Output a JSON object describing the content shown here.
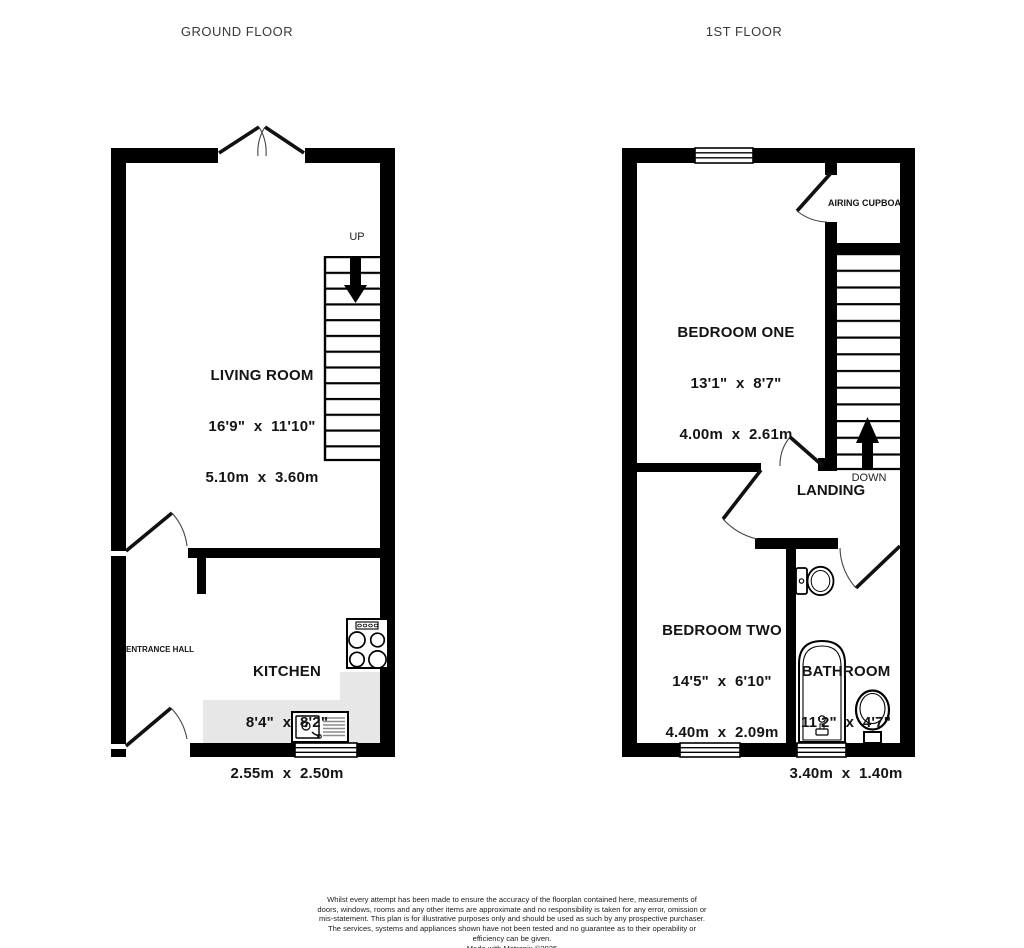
{
  "titles": {
    "ground": "GROUND FLOOR",
    "first": "1ST FLOOR"
  },
  "rooms": {
    "living_room": {
      "name": "LIVING ROOM",
      "imperial": "16'9\"  x  11'10\"",
      "metric": "5.10m  x  3.60m"
    },
    "kitchen": {
      "name": "KITCHEN",
      "imperial": "8'4\"  x  8'2\"",
      "metric": "2.55m  x  2.50m"
    },
    "bedroom_one": {
      "name": "BEDROOM ONE",
      "imperial": "13'1\"  x  8'7\"",
      "metric": "4.00m  x  2.61m"
    },
    "bedroom_two": {
      "name": "BEDROOM TWO",
      "imperial": "14'5\"  x  6'10\"",
      "metric": "4.40m  x  2.09m"
    },
    "bathroom": {
      "name": "BATHROOM",
      "imperial": "11'2\"  x  4'7\"",
      "metric": "3.40m  x  1.40m"
    }
  },
  "labels": {
    "entrance_hall": "ENTRANCE HALL",
    "airing_cupboard": "AIRING CUPBOARD",
    "landing": "LANDING",
    "up": "UP",
    "down": "DOWN"
  },
  "footer": {
    "disclaimer": "Whilst every attempt has been made to ensure the accuracy of the floorplan contained here, measurements of doors, windows, rooms and any other items are approximate and no responsibility is taken for any error, omission or mis-statement. This plan is for illustrative purposes only and should be used as such by any prospective purchaser. The services, systems and appliances shown have not been tested and no guarantee as to their operability or efficiency can be given.",
    "credit": "Made with Metropix ©2025"
  },
  "colors": {
    "wall": "#000000",
    "counter": "#e7e7e7",
    "text": "#141414"
  }
}
